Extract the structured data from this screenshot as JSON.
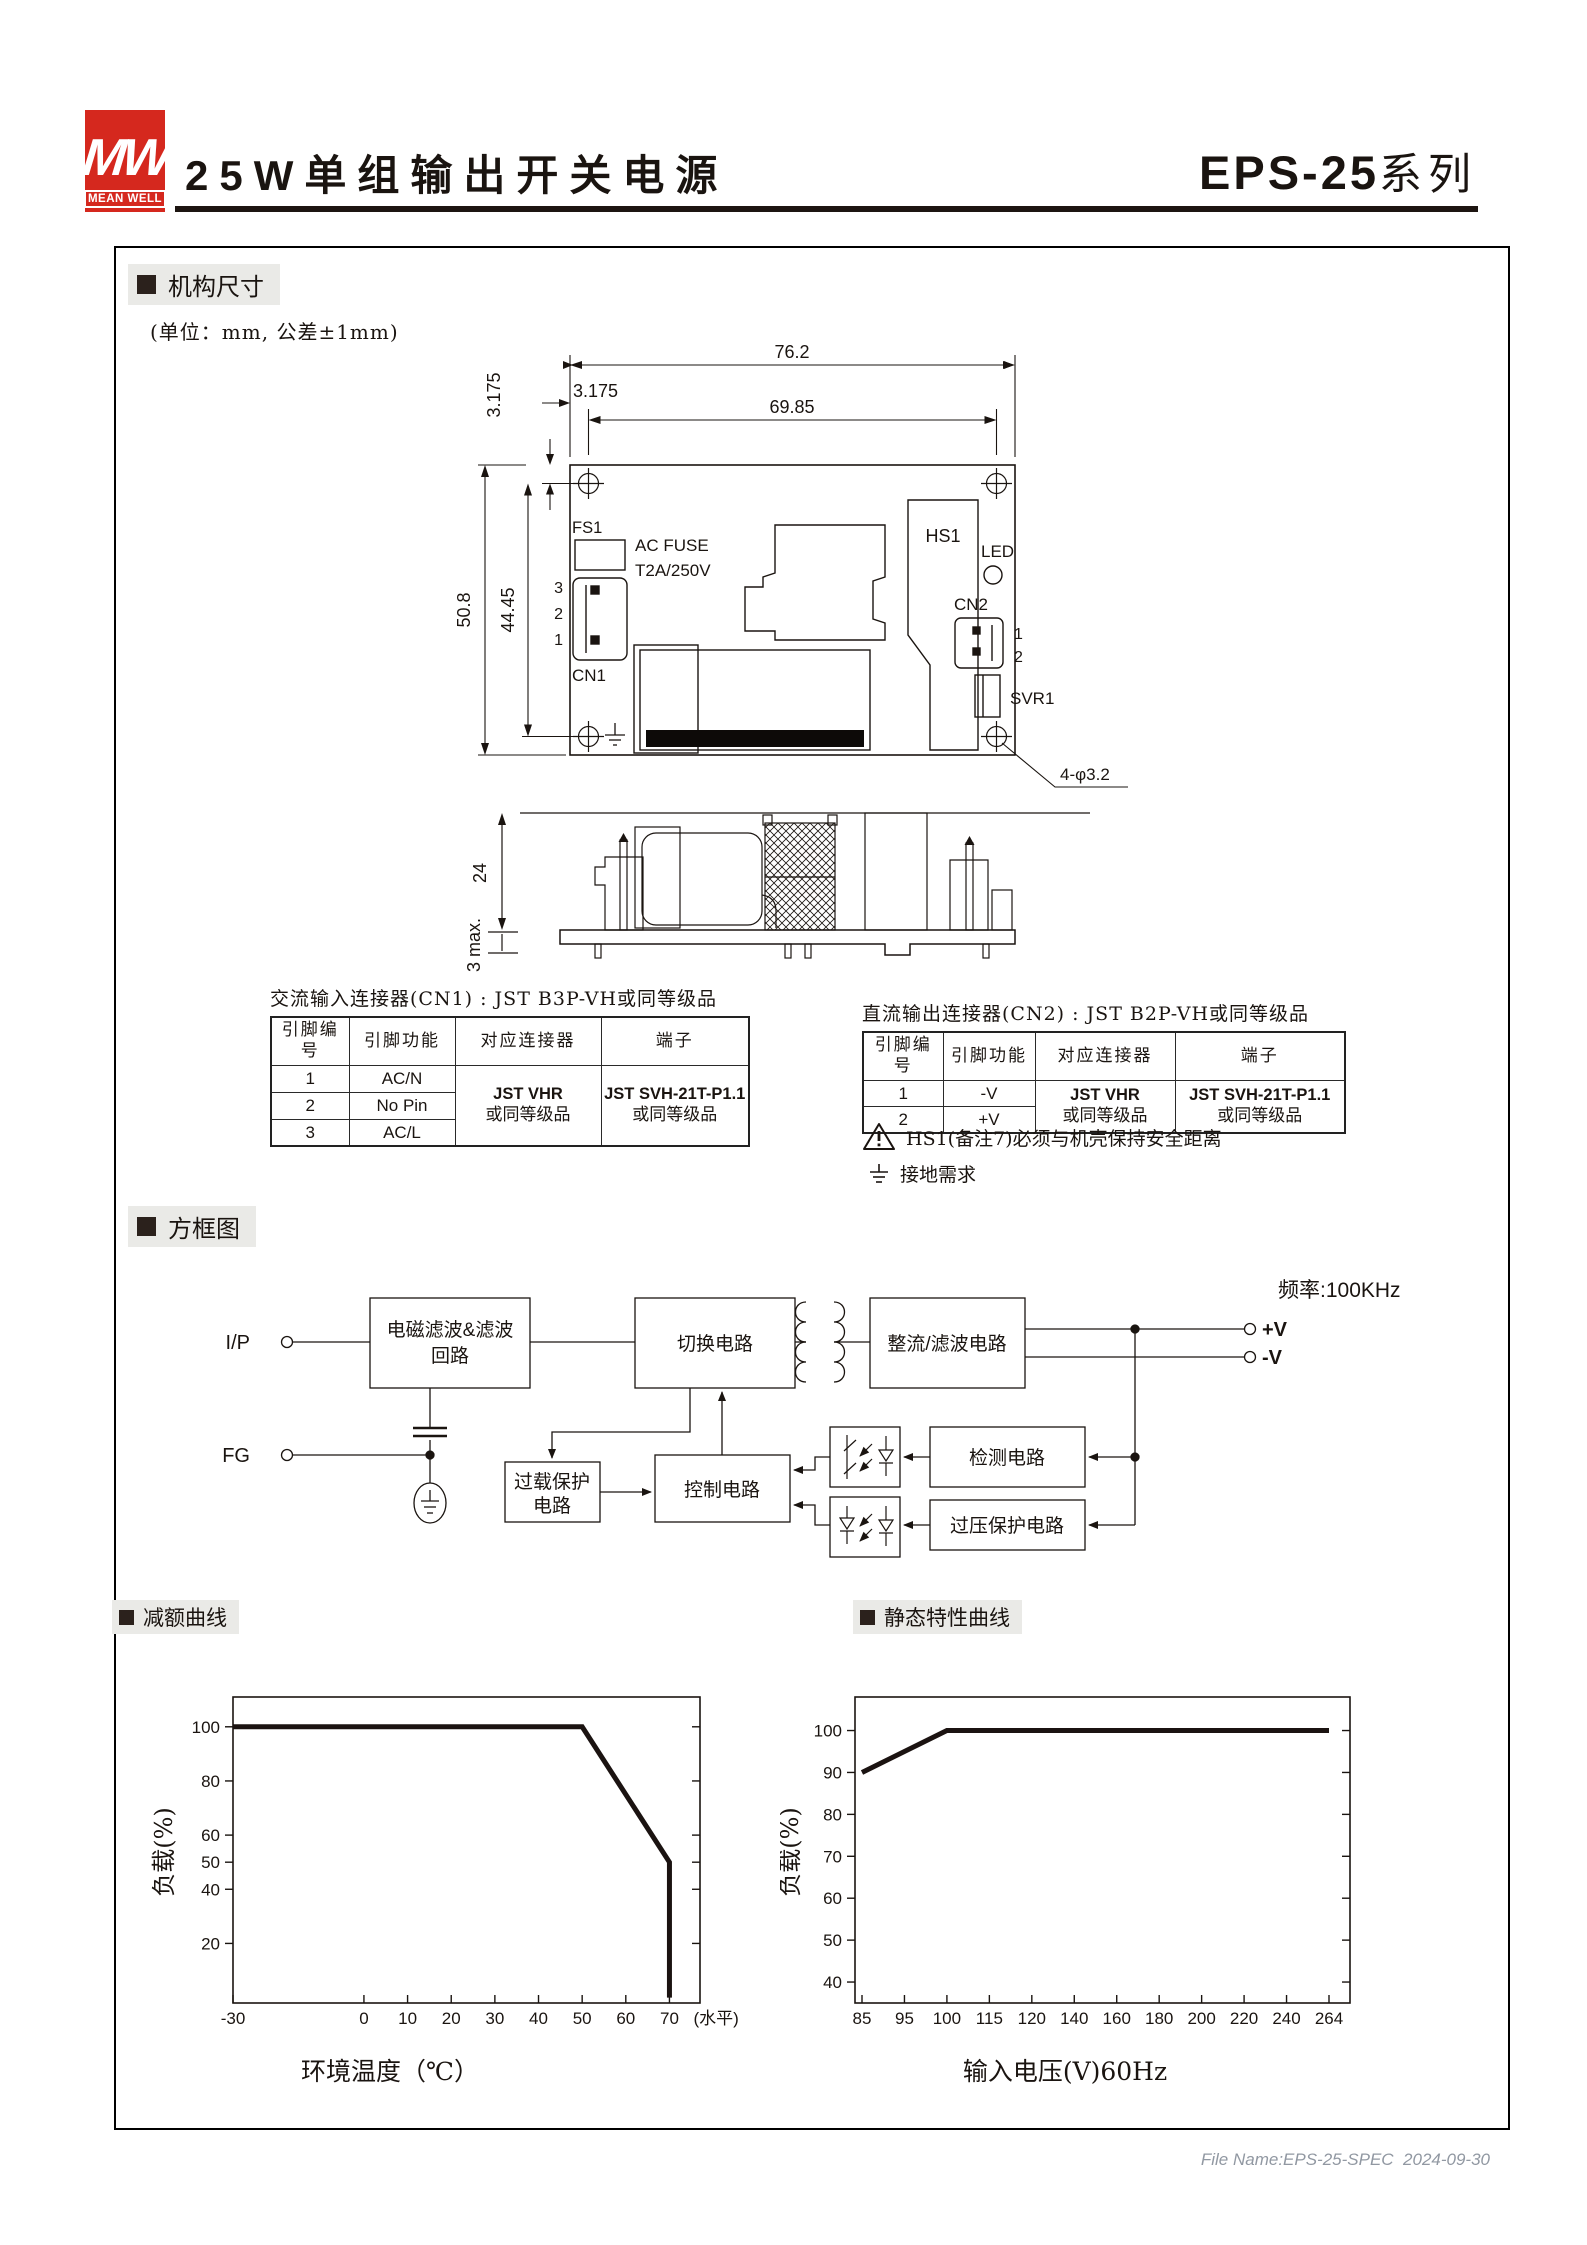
{
  "header": {
    "logo_mw": "MW",
    "logo_brand": "MEAN WELL",
    "logo_color": "#d5281e",
    "title": "25W单组输出开关电源",
    "series_bold": "EPS-25",
    "series_rest": "系列"
  },
  "sections": {
    "mechanical": "机构尺寸",
    "block": "方框图",
    "derating": "减额曲线",
    "static": "静态特性曲线"
  },
  "mechanical": {
    "unit_note": "(单位：mm, 公差±1mm)",
    "top_view": {
      "dim_width": "76.2",
      "dim_inner_width": "69.85",
      "dim_inset_left": "3.175",
      "dim_inset_top": "3.175",
      "dim_height": "50.8",
      "dim_inner_height": "44.45",
      "hole_note": "4-φ3.2",
      "fs1": "FS1",
      "fuse_line1": "AC FUSE",
      "fuse_line2": "T2A/250V",
      "cn1": "CN1",
      "pin3": "3",
      "pin2": "2",
      "pin1": "1",
      "hs1": "HS1",
      "led": "LED",
      "cn2": "CN2",
      "cn2_pin1": "1",
      "cn2_pin2": "2",
      "svr1": "SVR1"
    },
    "side_view": {
      "dim_height": "24",
      "dim_pins": "3 max."
    }
  },
  "cn1_table": {
    "title": "交流输入连接器(CN1) : JST B3P-VH或同等级品",
    "headers": [
      "引脚编号",
      "引脚功能",
      "对应连接器",
      "端子"
    ],
    "rows": [
      [
        "1",
        "AC/N"
      ],
      [
        "2",
        "No Pin"
      ],
      [
        "3",
        "AC/L"
      ]
    ],
    "connector": [
      "JST VHR",
      "或同等级品"
    ],
    "terminal": [
      "JST SVH-21T-P1.1",
      "或同等级品"
    ]
  },
  "cn2_table": {
    "title": "直流输出连接器(CN2) : JST B2P-VH或同等级品",
    "headers": [
      "引脚编号",
      "引脚功能",
      "对应连接器",
      "端子"
    ],
    "rows": [
      [
        "1",
        "-V"
      ],
      [
        "2",
        "+V"
      ]
    ],
    "connector": [
      "JST VHR",
      "或同等级品"
    ],
    "terminal": [
      "JST SVH-21T-P1.1",
      "或同等级品"
    ],
    "warning": "HS1(备注7)必须与机壳保持安全距离",
    "ground_note": "接地需求"
  },
  "block_diagram": {
    "frequency": "频率:100KHz",
    "ip": "I/P",
    "fg": "FG",
    "vp": "+V",
    "vm": "-V",
    "emi1": "电磁滤波&滤波",
    "emi2": "回路",
    "switch": "切换电路",
    "rect": "整流/滤波电路",
    "overload1": "过载保护",
    "overload2": "电路",
    "control": "控制电路",
    "detect": "检测电路",
    "ovp": "过压保护电路"
  },
  "chart_data": [
    {
      "type": "line",
      "name": "derating",
      "title": "减额曲线",
      "xlabel": "环境温度（℃）",
      "ylabel": "负载(%)",
      "x_ticks": [
        -30,
        0,
        10,
        20,
        30,
        40,
        50,
        60,
        70
      ],
      "x_suffix": "(水平)",
      "y_ticks": [
        20,
        40,
        50,
        60,
        80,
        100
      ],
      "xlim": [
        -30,
        77
      ],
      "ylim": [
        -2,
        111
      ],
      "grid": false,
      "points": [
        [
          -30,
          100
        ],
        [
          50,
          100
        ],
        [
          70,
          50
        ],
        [
          70,
          0
        ]
      ]
    },
    {
      "type": "line",
      "name": "static-characteristic",
      "title": "静态特性曲线",
      "xlabel": "输入电压(V)60Hz",
      "ylabel": "负载(%)",
      "x_mode": "index",
      "x_tick_values": [
        85,
        95,
        100,
        115,
        120,
        140,
        160,
        180,
        200,
        220,
        240,
        264
      ],
      "x_tick_labels": [
        "85",
        "95",
        "100",
        "115",
        "120",
        "140",
        "160",
        "180",
        "200",
        "220",
        "240",
        "264"
      ],
      "y_ticks": [
        40,
        50,
        60,
        70,
        80,
        90,
        100
      ],
      "ylim": [
        35,
        108
      ],
      "grid": false,
      "points": [
        [
          85,
          90
        ],
        [
          100,
          100
        ],
        [
          264,
          100
        ]
      ]
    }
  ],
  "footer": {
    "file_name": "File Name:EPS-25-SPEC  2024-09-30"
  }
}
